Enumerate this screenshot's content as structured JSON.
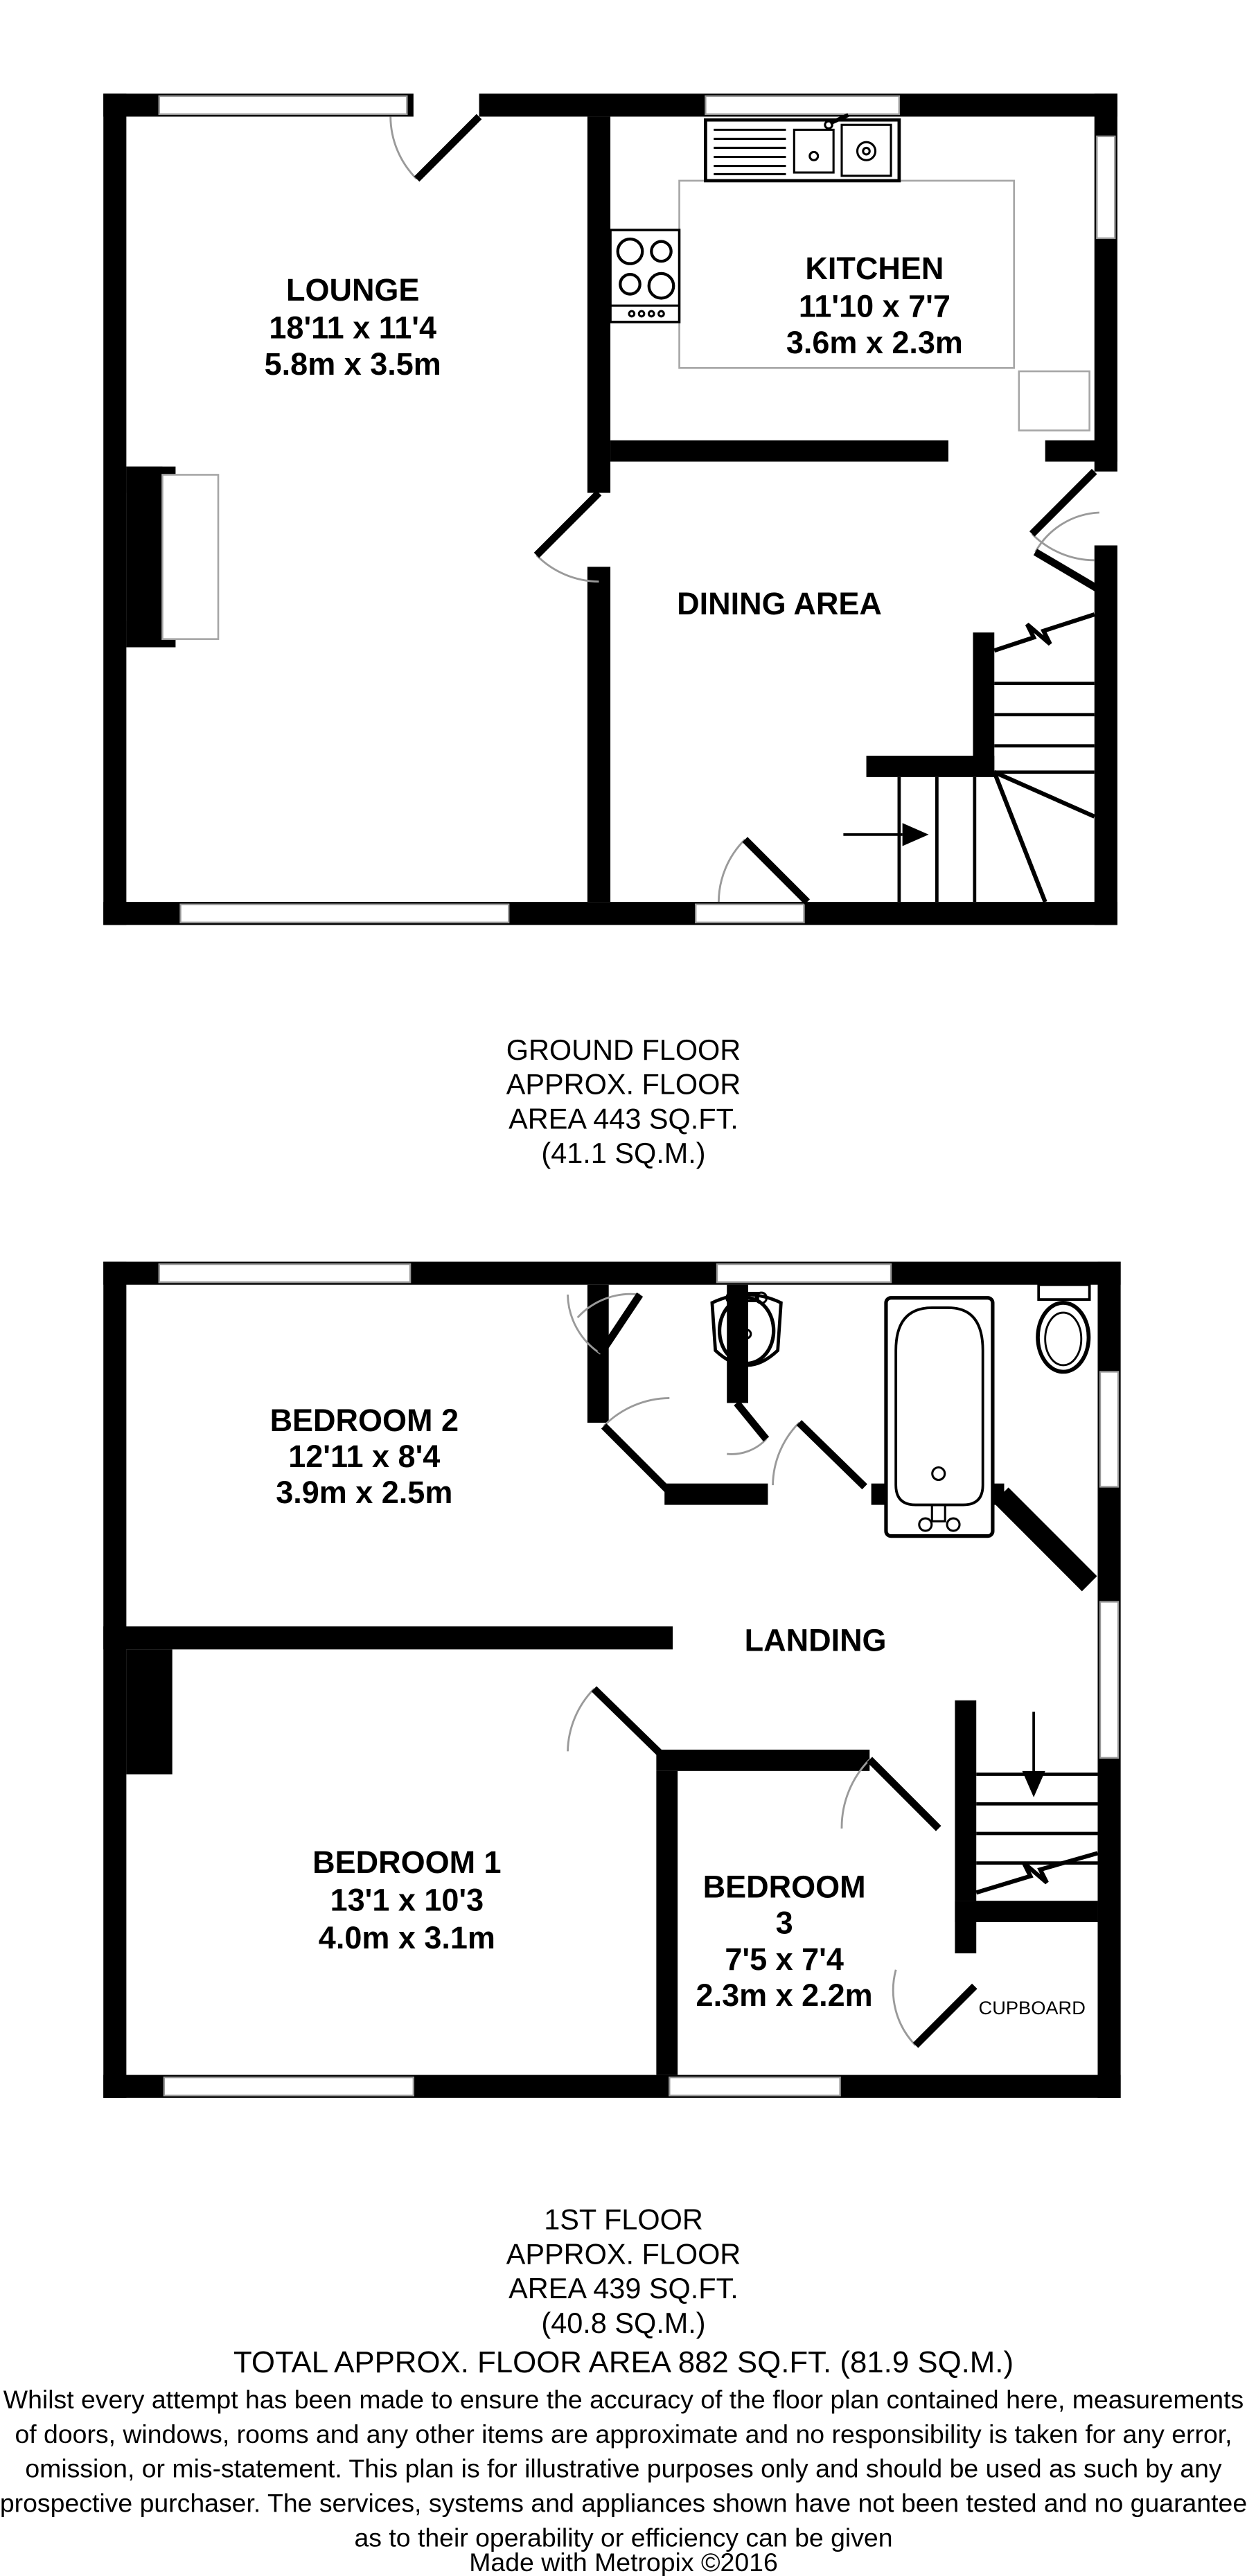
{
  "ground_floor": {
    "rooms": {
      "lounge": {
        "name": "LOUNGE",
        "imperial": "18'11 x 11'4",
        "metric": "5.8m x 3.5m"
      },
      "kitchen": {
        "name": "KITCHEN",
        "imperial": "11'10 x 7'7",
        "metric": "3.6m x 2.3m"
      },
      "dining": {
        "name": "DINING AREA"
      }
    },
    "caption": [
      "GROUND FLOOR",
      "APPROX. FLOOR",
      "AREA 443 SQ.FT.",
      "(41.1 SQ.M.)"
    ]
  },
  "first_floor": {
    "rooms": {
      "bedroom2": {
        "name": "BEDROOM 2",
        "imperial": "12'11 x 8'4",
        "metric": "3.9m x 2.5m"
      },
      "bedroom1": {
        "name": "BEDROOM 1",
        "imperial": "13'1 x 10'3",
        "metric": "4.0m x 3.1m"
      },
      "bedroom3": {
        "name_line1": "BEDROOM",
        "name_line2": "3",
        "imperial": "7'5 x 7'4",
        "metric": "2.3m x 2.2m"
      },
      "landing": {
        "name": "LANDING"
      },
      "cupboard": {
        "name": "CUPBOARD"
      }
    },
    "caption": [
      "1ST FLOOR",
      "APPROX. FLOOR",
      "AREA 439 SQ.FT.",
      "(40.8 SQ.M.)"
    ]
  },
  "total_area": "TOTAL APPROX. FLOOR AREA 882 SQ.FT. (81.9 SQ.M.)",
  "disclaimer": [
    "Whilst every attempt has been made to ensure the accuracy of the floor plan contained here, measurements",
    "of doors, windows, rooms and any other items are approximate and no responsibility is taken for any error,",
    "omission, or mis-statement. This plan is for illustrative purposes only and should be used as such by any",
    "prospective purchaser. The services, systems and appliances shown have not been tested and no guarantee",
    "as to their operability or efficiency can be given"
  ],
  "credit": "Made with Metropix ©2016",
  "colors": {
    "wall": "#000000",
    "background": "#ffffff",
    "fixture_line": "#999999"
  }
}
